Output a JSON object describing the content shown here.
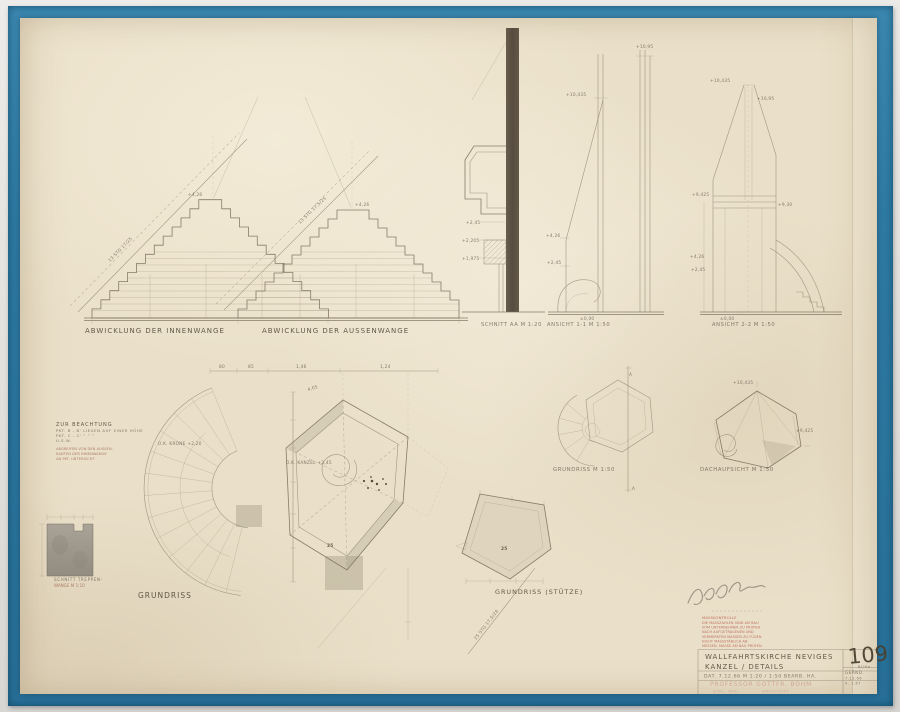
{
  "photo": {
    "background": "#e4e2de",
    "frame_blue": "#2d7aa4",
    "paper": "#eae0c9",
    "stamp_red": "#b0493e"
  },
  "labels": {
    "abwicklung_innen": "ABWICKLUNG DER INNENWANGE",
    "abwicklung_aussen": "ABWICKLUNG DER AUSSENWANGE",
    "schnitt_aa": "SCHNITT AA  M 1:20",
    "ansicht_11": "ANSICHT 1-1  M 1:50",
    "ansicht_22": "ANSICHT 2-2  M 1:50",
    "grundriss": "GRUNDRISS",
    "grundriss_m150": "GRUNDRISS  M 1:50",
    "dachaufsicht": "DACHAUFSICHT  M 1:50",
    "grundriss_stuetze": "GRUNDRISS (STÜTZE)",
    "wange_1": "SCHNITT TREPPEN-",
    "wange_2": "WANGE  M 1:10"
  },
  "note": {
    "title": "ZUR BEACHTUNG",
    "line1": "PKT. B - B' LIEGEN AUF EINER HÖHE",
    "line2": "PKT. C - C'    ”       ”       ”",
    "line3": "U.S.W.",
    "red1": "ABGREIFEN VON DEN AUSSEN-",
    "red2": "KANTEN DER INNENWANGE",
    "red3": "AN PKT. UNTERSICHT"
  },
  "stamp_lines": [
    "MASSKONTROLLE",
    "DIE MASSZAHLEN SIND AM BAU",
    "VOM UNTERNEHMER ZU PRÜFEN",
    "NACH AUFGETRAGENEN UND",
    "VERMERKTEN MASSEN ZU FÜGEN",
    "NICHT MASSSTÄBLICH AB-",
    "MESSEN. MASSE AM BAU PRÜFEN"
  ],
  "title_block": {
    "project": "WALLFAHRTSKIRCHE NEVIGES",
    "subject": "KANZEL / DETAILS",
    "meta": "DAT. 7.12.66    M 1:20 / 1:50    BEARB.  HA.",
    "architect_name": "PROFESSOR GOTTFR. BÖHM",
    "architect_left": "DIPL. ING.",
    "architect_right": "ARCHITEKT",
    "number": "109",
    "number_sub": "Bl/Ha",
    "geaend_label": "GEÄND.",
    "geaend_1": "7.12.66",
    "geaend_2": "9. 1.67"
  },
  "annotations": [
    {
      "t": "13 STG 17/25",
      "x": 110,
      "y": 262,
      "r": -46
    },
    {
      "t": "13 STG 17,5/25",
      "x": 300,
      "y": 224,
      "r": -44
    },
    {
      "t": "+4,26",
      "x": 188,
      "y": 196
    },
    {
      "t": "+4,26",
      "x": 355,
      "y": 206
    },
    {
      "t": "+2,45",
      "x": 466,
      "y": 224
    },
    {
      "t": "+2,205",
      "x": 462,
      "y": 242
    },
    {
      "t": "+1,975",
      "x": 462,
      "y": 260
    },
    {
      "t": "+10,435",
      "x": 566,
      "y": 96
    },
    {
      "t": "+10,95",
      "x": 636,
      "y": 48
    },
    {
      "t": "+4,26",
      "x": 546,
      "y": 237
    },
    {
      "t": "+2,45",
      "x": 547,
      "y": 264
    },
    {
      "t": "±0,00",
      "x": 580,
      "y": 320
    },
    {
      "t": "+10,435",
      "x": 710,
      "y": 82
    },
    {
      "t": "+10,95",
      "x": 757,
      "y": 100
    },
    {
      "t": "+9,425",
      "x": 692,
      "y": 196
    },
    {
      "t": "+9,30",
      "x": 778,
      "y": 206
    },
    {
      "t": "+4,26",
      "x": 690,
      "y": 258
    },
    {
      "t": "+2,45",
      "x": 691,
      "y": 271
    },
    {
      "t": "±0,00",
      "x": 720,
      "y": 320
    },
    {
      "t": "O.K. KRONE +2,20",
      "x": 158,
      "y": 445
    },
    {
      "t": "O.K. KANZEL +2,45",
      "x": 286,
      "y": 464
    },
    {
      "t": "80",
      "x": 219,
      "y": 368
    },
    {
      "t": "85",
      "x": 248,
      "y": 368
    },
    {
      "t": "1,46",
      "x": 296,
      "y": 368
    },
    {
      "t": "1,24",
      "x": 380,
      "y": 368
    },
    {
      "t": "4,05",
      "x": 308,
      "y": 391,
      "r": -17
    },
    {
      "t": "25",
      "x": 327,
      "y": 547,
      "b": 1,
      "s": 7
    },
    {
      "t": "25",
      "x": 501,
      "y": 550,
      "b": 1,
      "s": 7
    },
    {
      "t": "25 STG 17,5/26",
      "x": 476,
      "y": 640,
      "r": -52
    },
    {
      "t": "A",
      "x": 629,
      "y": 376,
      "s": 5
    },
    {
      "t": "A",
      "x": 632,
      "y": 490,
      "s": 5
    },
    {
      "t": "+10,435",
      "x": 733,
      "y": 384
    },
    {
      "t": "+9,425",
      "x": 796,
      "y": 432
    }
  ]
}
